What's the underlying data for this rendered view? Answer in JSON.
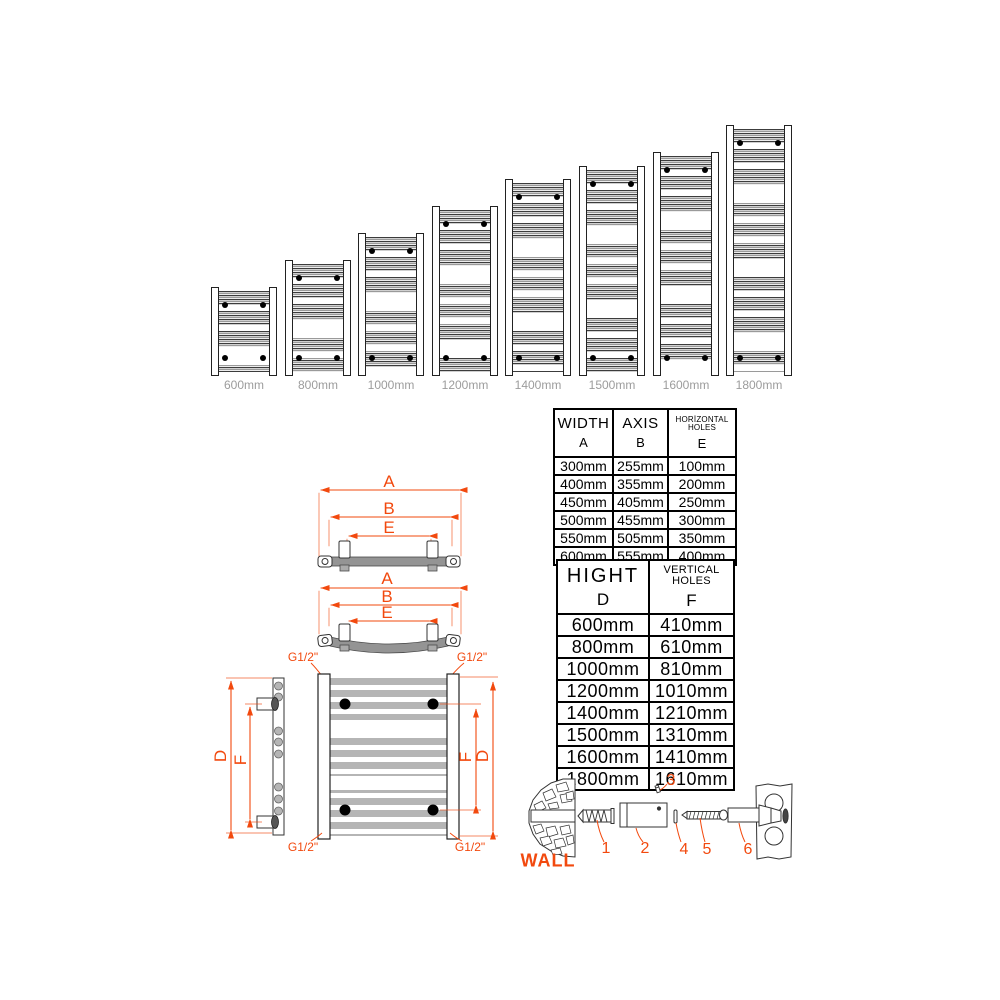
{
  "colors": {
    "accent": "#f2490e",
    "label_gray": "#9c9c9c"
  },
  "radiators": {
    "items": [
      {
        "label": "600mm"
      },
      {
        "label": "800mm"
      },
      {
        "label": "1000mm"
      },
      {
        "label": "1200mm"
      },
      {
        "label": "1400mm"
      },
      {
        "label": "1500mm"
      },
      {
        "label": "1600mm"
      },
      {
        "label": "1800mm"
      }
    ]
  },
  "width_table": {
    "col1_title": "WIDTH",
    "col1_letter": "A",
    "col2_title": "AXIS",
    "col2_letter": "B",
    "col3_title": "HORİZONTAL HOLES",
    "col3_letter": "E",
    "rows": [
      [
        "300mm",
        "255mm",
        "100mm"
      ],
      [
        "400mm",
        "355mm",
        "200mm"
      ],
      [
        "450mm",
        "405mm",
        "250mm"
      ],
      [
        "500mm",
        "455mm",
        "300mm"
      ],
      [
        "550mm",
        "505mm",
        "350mm"
      ],
      [
        "600mm",
        "555mm",
        "400mm"
      ]
    ]
  },
  "height_table": {
    "col1_title": "HIGHT",
    "col1_letter": "D",
    "col2_title": "VERTICAL HOLES",
    "col2_letter": "F",
    "rows": [
      [
        "600mm",
        "410mm"
      ],
      [
        "800mm",
        "610mm"
      ],
      [
        "1000mm",
        "810mm"
      ],
      [
        "1200mm",
        "1010mm"
      ],
      [
        "1400mm",
        "1210mm"
      ],
      [
        "1500mm",
        "1310mm"
      ],
      [
        "1600mm",
        "1410mm"
      ],
      [
        "1800mm",
        "1610mm"
      ]
    ]
  },
  "dim_labels": {
    "a": "A",
    "b": "B",
    "e": "E",
    "d": "D",
    "f": "F",
    "thread": "G1/2\""
  },
  "hardware": {
    "wall": "WALL",
    "n1": "1",
    "n2": "2",
    "n3": "3",
    "n4": "4",
    "n5": "5",
    "n6": "6"
  }
}
